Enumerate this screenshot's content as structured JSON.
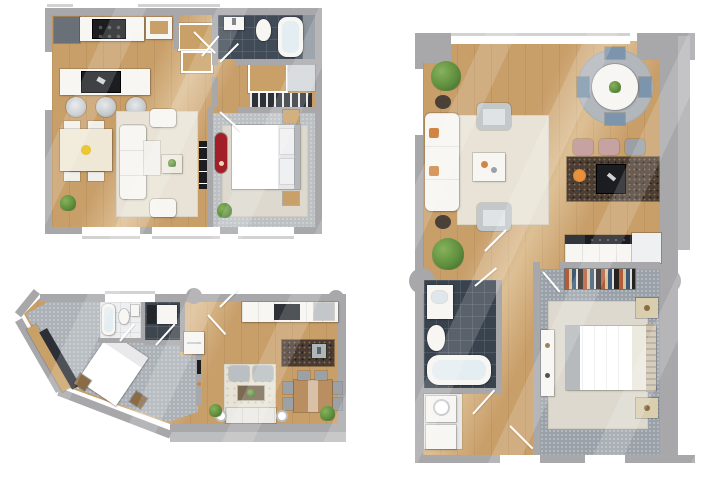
{
  "meta": {
    "description": "Three 3D-rendered apartment floor plans shown top-down on a white background",
    "plan_count": 3,
    "canvas": {
      "width": 720,
      "height": 480
    },
    "background": "#ffffff"
  },
  "palette": {
    "bg": "#ffffff",
    "wall": "#a8a8aa",
    "wallLight": "#b9b9bb",
    "sill": "#d2d2d3",
    "wood": "#c89e69",
    "carpetA": "#bcc0c2",
    "carpetB": "#9aa1a8",
    "carpetC": "#abb1b6",
    "rugLight": "#ddd9cf",
    "rugPale": "#e8e3d6",
    "tileDark": "#414b57",
    "tileLight": "#edeff0",
    "furnWhite": "#f7f6f2",
    "island": "#4c3e33",
    "counterDark": "#2f3237",
    "black": "#1b1d20",
    "accentRed": "#a21f27",
    "green": "#5f8f3e",
    "greenDark": "#3c652a",
    "orange": "#d08642",
    "blue": "#7d95ac",
    "pink": "#c6a2a3",
    "tan": "#c9a168",
    "woodFurn": "#b98e60",
    "steel": "#c3c7c9"
  },
  "plans": [
    {
      "id": "plan-1",
      "position": "top-left",
      "shape": "rectangular",
      "rooms": [
        {
          "name": "kitchen",
          "floor": "wood",
          "furniture": [
            "refrigerator",
            "counter with stove",
            "wall cabinet",
            "island with cooktop",
            "3 bar stools"
          ]
        },
        {
          "name": "entry",
          "floor": "wood",
          "furniture": [
            "wardrobe closet",
            "bench"
          ]
        },
        {
          "name": "bathroom",
          "floor": "dark tile",
          "furniture": [
            "sink",
            "toilet",
            "bathtub"
          ]
        },
        {
          "name": "hall closet",
          "floor": "wood",
          "furniture": [
            "shelf unit",
            "radiator"
          ]
        },
        {
          "name": "living-dining",
          "floor": "wood",
          "furniture": [
            "dining table",
            "4 dining chairs",
            "flower vase",
            "area rug",
            "sofa with chaise",
            "2 armchairs",
            "coffee table",
            "tv console",
            "2 plants"
          ]
        },
        {
          "name": "bedroom",
          "floor": "carpet",
          "furniture": [
            "double bed",
            "2 nightstands",
            "red dresser",
            "plant",
            "rug"
          ]
        }
      ],
      "openings": {
        "windows": 4,
        "door_swings": 4
      }
    },
    {
      "id": "plan-2",
      "position": "right",
      "shape": "tall rectangular",
      "rooms": [
        {
          "name": "living room",
          "floor": "wood",
          "furniture": [
            "white sofa with orange pillows",
            "2 armchairs",
            "2 side tables",
            "coffee table",
            "area rug",
            "plant"
          ]
        },
        {
          "name": "dining area",
          "floor": "wood",
          "furniture": [
            "round white table",
            "4 chairs with blue cushions",
            "round rug",
            "centerpiece plant"
          ]
        },
        {
          "name": "kitchen",
          "floor": "wood",
          "furniture": [
            "stone island with cooktop",
            "3 bar stools",
            "fruit bowl",
            "counter with oven",
            "refrigerator"
          ]
        },
        {
          "name": "bathroom",
          "floor": "dark tile",
          "furniture": [
            "vanity sink",
            "toilet",
            "bathtub"
          ]
        },
        {
          "name": "laundry closet",
          "floor": "light",
          "furniture": [
            "washer",
            "dryer"
          ]
        },
        {
          "name": "bedroom",
          "floor": "carpet",
          "furniture": [
            "double bed",
            "2 nightstands",
            "dresser",
            "built-in wardrobe with clothes",
            "area rug"
          ]
        },
        {
          "name": "hallway",
          "floor": "wood",
          "furniture": [
            "plant"
          ]
        }
      ],
      "openings": {
        "windows": 5,
        "door_swings": 5,
        "wall_columns": 2
      }
    },
    {
      "id": "plan-3",
      "position": "bottom-left",
      "shape": "irregular angled polygon",
      "rooms": [
        {
          "name": "bedroom",
          "floor": "carpet",
          "furniture": [
            "angled double bed",
            "2 nightstands",
            "wardrobe along slanted wall"
          ]
        },
        {
          "name": "bathroom",
          "floor": "light tile",
          "furniture": [
            "bathtub",
            "toilet",
            "sink"
          ]
        },
        {
          "name": "shower room",
          "floor": "dark tile",
          "furniture": [
            "shower tray",
            "cabinet"
          ]
        },
        {
          "name": "entry",
          "floor": "wood",
          "furniture": [
            "closet"
          ]
        },
        {
          "name": "living room",
          "floor": "wood",
          "furniture": [
            "2 armchairs",
            "sofa",
            "2 side lamps",
            "coffee table",
            "area rug",
            "tv wall",
            "2 plants"
          ]
        },
        {
          "name": "kitchen",
          "floor": "wood",
          "furniture": [
            "counter with range",
            "stone island with sink",
            "steel cabinet"
          ]
        },
        {
          "name": "dining area",
          "floor": "wood",
          "furniture": [
            "wood table",
            "6 gray chairs"
          ]
        }
      ],
      "openings": {
        "windows": 1,
        "door_swings": 4,
        "wall_columns": 2,
        "terrace": "gray ledge along bottom edge"
      }
    }
  ]
}
